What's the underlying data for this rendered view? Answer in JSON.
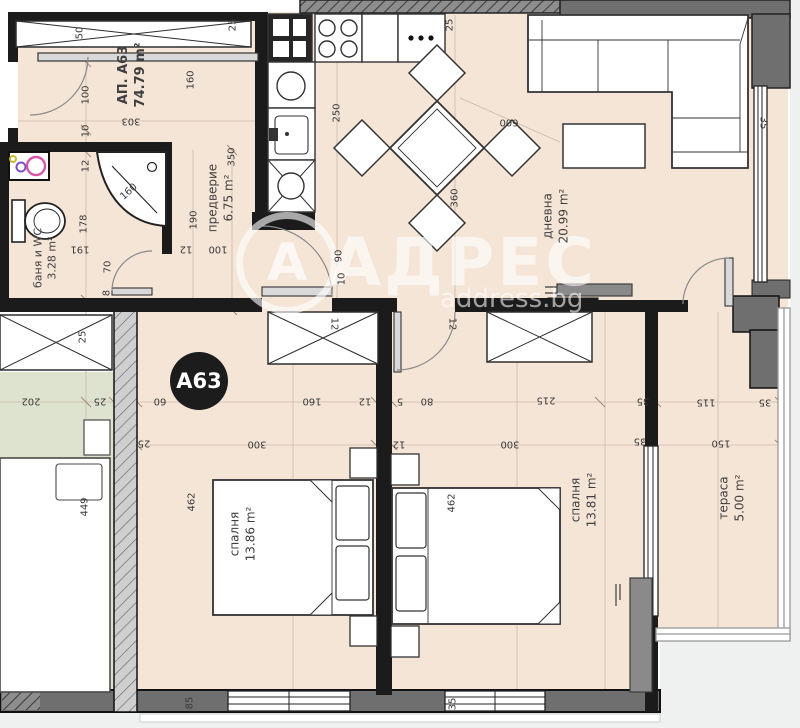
{
  "header": {
    "badge": "А63"
  },
  "watermark": {
    "brand": "АДРЕС",
    "logo_letter": "А",
    "site": "address.bg"
  },
  "colors": {
    "floor": "#f5e5d7",
    "neighbor_floor": "#dee3cf",
    "wall_black": "#1b1b1b",
    "wall_gray": "#6f6f6f",
    "badge_bg": "#1c1c1c",
    "vanity_pink": "#d958a8"
  },
  "rooms": [
    {
      "name": "АП. А63",
      "area": "74.79 m²",
      "x": 133,
      "y": 75,
      "rot": -90,
      "bold": true,
      "size": 13
    },
    {
      "name": "баня и WC",
      "area": "3.28 m²",
      "x": 46,
      "y": 258,
      "rot": -90,
      "size": 11
    },
    {
      "name": "предверие",
      "area": "6.75 m²",
      "x": 221,
      "y": 198,
      "rot": -90,
      "size": 12
    },
    {
      "name": "дневна",
      "area": "20.99 m²",
      "x": 556,
      "y": 216,
      "rot": -90,
      "size": 12
    },
    {
      "name": "спалня",
      "area": "13.86 m²",
      "x": 243,
      "y": 534,
      "rot": -90,
      "size": 12
    },
    {
      "name": "спалня",
      "area": "13.81 m²",
      "x": 584,
      "y": 500,
      "rot": -90,
      "size": 12
    },
    {
      "name": "тераса",
      "area": "5.00 m²",
      "x": 732,
      "y": 498,
      "rot": -90,
      "size": 12
    }
  ],
  "dimensions": [
    {
      "t": "50",
      "x": 80,
      "y": 33,
      "r": -90
    },
    {
      "t": "25",
      "x": 233,
      "y": 25,
      "r": -90
    },
    {
      "t": "100",
      "x": 86,
      "y": 95,
      "r": -90
    },
    {
      "t": "160",
      "x": 191,
      "y": 80,
      "r": -90
    },
    {
      "t": "303",
      "x": 131,
      "y": 121,
      "r": 180
    },
    {
      "t": "10",
      "x": 86,
      "y": 131,
      "r": -90
    },
    {
      "t": "12",
      "x": 86,
      "y": 166,
      "r": -90
    },
    {
      "t": "178",
      "x": 84,
      "y": 224,
      "r": -90
    },
    {
      "t": "191",
      "x": 80,
      "y": 249,
      "r": 180
    },
    {
      "t": "70",
      "x": 108,
      "y": 267,
      "r": -90
    },
    {
      "t": "8",
      "x": 107,
      "y": 293,
      "r": -90
    },
    {
      "t": "160",
      "x": 129,
      "y": 192,
      "r": -42
    },
    {
      "t": "190",
      "x": 194,
      "y": 220,
      "r": -90
    },
    {
      "t": "12",
      "x": 186,
      "y": 249,
      "r": 180
    },
    {
      "t": "100",
      "x": 218,
      "y": 249,
      "r": 180
    },
    {
      "t": "350",
      "x": 232,
      "y": 157,
      "r": -90
    },
    {
      "t": "90",
      "x": 339,
      "y": 256,
      "r": -90
    },
    {
      "t": "10",
      "x": 342,
      "y": 279,
      "r": -90
    },
    {
      "t": "250",
      "x": 337,
      "y": 113,
      "r": -90
    },
    {
      "t": "25",
      "x": 450,
      "y": 25,
      "r": -90
    },
    {
      "t": "360",
      "x": 455,
      "y": 198,
      "r": -90
    },
    {
      "t": "600",
      "x": 509,
      "y": 122,
      "r": 180
    },
    {
      "t": "35",
      "x": 763,
      "y": 123,
      "r": 90
    },
    {
      "t": "202",
      "x": 31,
      "y": 401,
      "r": 180
    },
    {
      "t": "25",
      "x": 100,
      "y": 401,
      "r": 180
    },
    {
      "t": "60",
      "x": 160,
      "y": 401,
      "r": 180
    },
    {
      "t": "160",
      "x": 312,
      "y": 401,
      "r": 180
    },
    {
      "t": "12",
      "x": 365,
      "y": 401,
      "r": 180
    },
    {
      "t": "5",
      "x": 400,
      "y": 401,
      "r": 180
    },
    {
      "t": "80",
      "x": 427,
      "y": 401,
      "r": 180
    },
    {
      "t": "215",
      "x": 546,
      "y": 400,
      "r": 180
    },
    {
      "t": "35",
      "x": 643,
      "y": 401,
      "r": 180
    },
    {
      "t": "115",
      "x": 706,
      "y": 402,
      "r": 180
    },
    {
      "t": "35",
      "x": 765,
      "y": 402,
      "r": 180
    },
    {
      "t": "25",
      "x": 144,
      "y": 443,
      "r": 180
    },
    {
      "t": "300",
      "x": 257,
      "y": 444,
      "r": 180
    },
    {
      "t": "12",
      "x": 399,
      "y": 444,
      "r": 180
    },
    {
      "t": "300",
      "x": 510,
      "y": 444,
      "r": 180
    },
    {
      "t": "35",
      "x": 640,
      "y": 441,
      "r": 180
    },
    {
      "t": "150",
      "x": 721,
      "y": 443,
      "r": 180
    },
    {
      "t": "462",
      "x": 192,
      "y": 502,
      "r": -90
    },
    {
      "t": "462",
      "x": 452,
      "y": 503,
      "r": -90
    },
    {
      "t": "449",
      "x": 85,
      "y": 507,
      "r": -90
    },
    {
      "t": "25",
      "x": 83,
      "y": 337,
      "r": -90
    },
    {
      "t": "12",
      "x": 334,
      "y": 324,
      "r": 90
    },
    {
      "t": "12",
      "x": 452,
      "y": 324,
      "r": 90
    },
    {
      "t": "85",
      "x": 190,
      "y": 703,
      "r": -90
    },
    {
      "t": "35",
      "x": 453,
      "y": 704,
      "r": -90
    }
  ]
}
